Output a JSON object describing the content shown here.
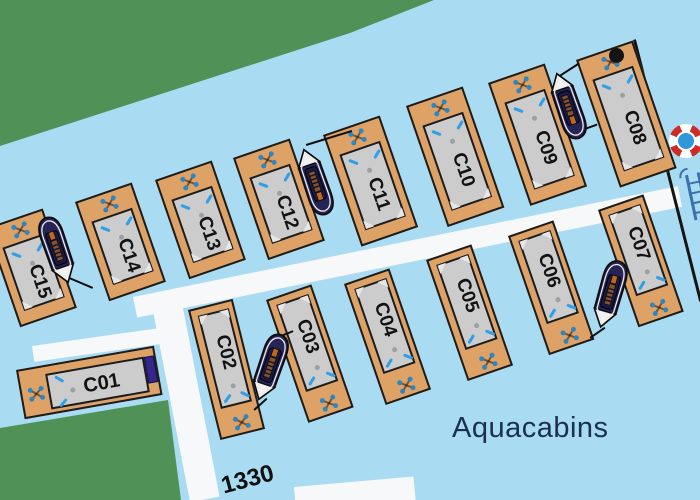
{
  "map_title": {
    "area_label": "Aquacabins",
    "pier_number": "1330"
  },
  "colors": {
    "water": "#a9dbf2",
    "land": "#4f9156",
    "dock": "#dfa266",
    "dock_outline": "#1c1c1c",
    "cabin": "#cccccc",
    "walkway": "#f6f8f9",
    "boat_hull": "#262457",
    "bow_white": "#f2f2f2",
    "pattern_blue": "#2b87c4",
    "dash_blue": "#2f9fe8",
    "roof_dot": "#9aa0a4",
    "label": "#121212",
    "title_text": "#1a3050",
    "number_text": "#101010",
    "navy_box": "#35268a",
    "ladder": "#3a70ac",
    "buoy_red": "#cf2b26",
    "buoy_center": "#2f98d8",
    "line_black": "#141414",
    "wedge": "#e6e6e6"
  },
  "icons": [
    "lifebuoy-icon",
    "ladder-icon",
    "mooring-post",
    "pier-edge-line"
  ],
  "docks": [
    {
      "id": "C01",
      "label": "C01",
      "x": 16,
      "y": 370,
      "w": 140,
      "h": 50,
      "rot": -10,
      "head": "left"
    },
    {
      "id": "C02",
      "label": "C02",
      "x": 188,
      "y": 310,
      "w": 46,
      "h": 134,
      "rot": -14,
      "head": "bottom"
    },
    {
      "id": "C03",
      "label": "C03",
      "x": 266,
      "y": 300,
      "w": 48,
      "h": 130,
      "rot": -19,
      "head": "bottom"
    },
    {
      "id": "C04",
      "label": "C04",
      "x": 344,
      "y": 284,
      "w": 48,
      "h": 128,
      "rot": -19,
      "head": "bottom"
    },
    {
      "id": "C05",
      "label": "C05",
      "x": 426,
      "y": 260,
      "w": 48,
      "h": 128,
      "rot": -19,
      "head": "bottom"
    },
    {
      "id": "C06",
      "label": "C06",
      "x": 508,
      "y": 236,
      "w": 48,
      "h": 126,
      "rot": -19,
      "head": "bottom"
    },
    {
      "id": "C07",
      "label": "C07",
      "x": 598,
      "y": 210,
      "w": 48,
      "h": 124,
      "rot": -19,
      "head": "bottom"
    },
    {
      "id": "C08",
      "label": "C08",
      "x": 576,
      "y": 60,
      "w": 60,
      "h": 135,
      "rot": -19,
      "head": "top"
    },
    {
      "id": "C09",
      "label": "C09",
      "x": 488,
      "y": 83,
      "w": 60,
      "h": 130,
      "rot": -19,
      "head": "top"
    },
    {
      "id": "C10",
      "label": "C10",
      "x": 406,
      "y": 106,
      "w": 60,
      "h": 128,
      "rot": -19,
      "head": "top"
    },
    {
      "id": "C11",
      "label": "C11",
      "x": 323,
      "y": 135,
      "w": 60,
      "h": 118,
      "rot": -19,
      "head": "top"
    },
    {
      "id": "C12",
      "label": "C12",
      "x": 233,
      "y": 158,
      "w": 60,
      "h": 108,
      "rot": -19,
      "head": "top"
    },
    {
      "id": "C13",
      "label": "C13",
      "x": 155,
      "y": 180,
      "w": 60,
      "h": 105,
      "rot": -19,
      "head": "top"
    },
    {
      "id": "C14",
      "label": "C14",
      "x": 75,
      "y": 202,
      "w": 60,
      "h": 105,
      "rot": -19,
      "head": "top"
    },
    {
      "id": "C15",
      "label": "C15",
      "x": -14,
      "y": 228,
      "w": 60,
      "h": 105,
      "rot": -19,
      "head": "top"
    }
  ],
  "boats": [
    {
      "x": 44,
      "y": 214,
      "rot": 161,
      "near": "C14-C15"
    },
    {
      "x": 302,
      "y": 146,
      "rot": -19,
      "near": "C11-C12"
    },
    {
      "x": 555,
      "y": 70,
      "rot": -19,
      "near": "C08-C09"
    },
    {
      "x": 597,
      "y": 258,
      "rot": 196,
      "near": "C06-C07"
    },
    {
      "x": 257,
      "y": 331,
      "rot": 199,
      "near": "C02-C03"
    }
  ],
  "mooring_lines": [
    {
      "x": 67,
      "y": 276,
      "len": 28,
      "rot": 23
    },
    {
      "x": 306,
      "y": 144,
      "len": 48,
      "rot": -17
    },
    {
      "x": 558,
      "y": 76,
      "len": 25,
      "rot": -33
    },
    {
      "x": 582,
      "y": 129,
      "len": 16,
      "rot": -20
    },
    {
      "x": 590,
      "y": 337,
      "len": 18,
      "rot": -35
    },
    {
      "x": 281,
      "y": 335,
      "len": 13,
      "rot": -22
    },
    {
      "x": 254,
      "y": 409,
      "len": 17,
      "rot": -42
    }
  ],
  "walkways": [
    {
      "x": 133,
      "y": 297,
      "w": 556,
      "h": 21,
      "rot": -11.5
    },
    {
      "x": 152,
      "y": 306,
      "w": 30,
      "h": 200,
      "rot": -11
    },
    {
      "x": 32,
      "y": 346,
      "w": 136,
      "h": 16,
      "rot": -8
    },
    {
      "x": 294,
      "y": 487,
      "w": 120,
      "h": 28,
      "rot": -5
    }
  ]
}
